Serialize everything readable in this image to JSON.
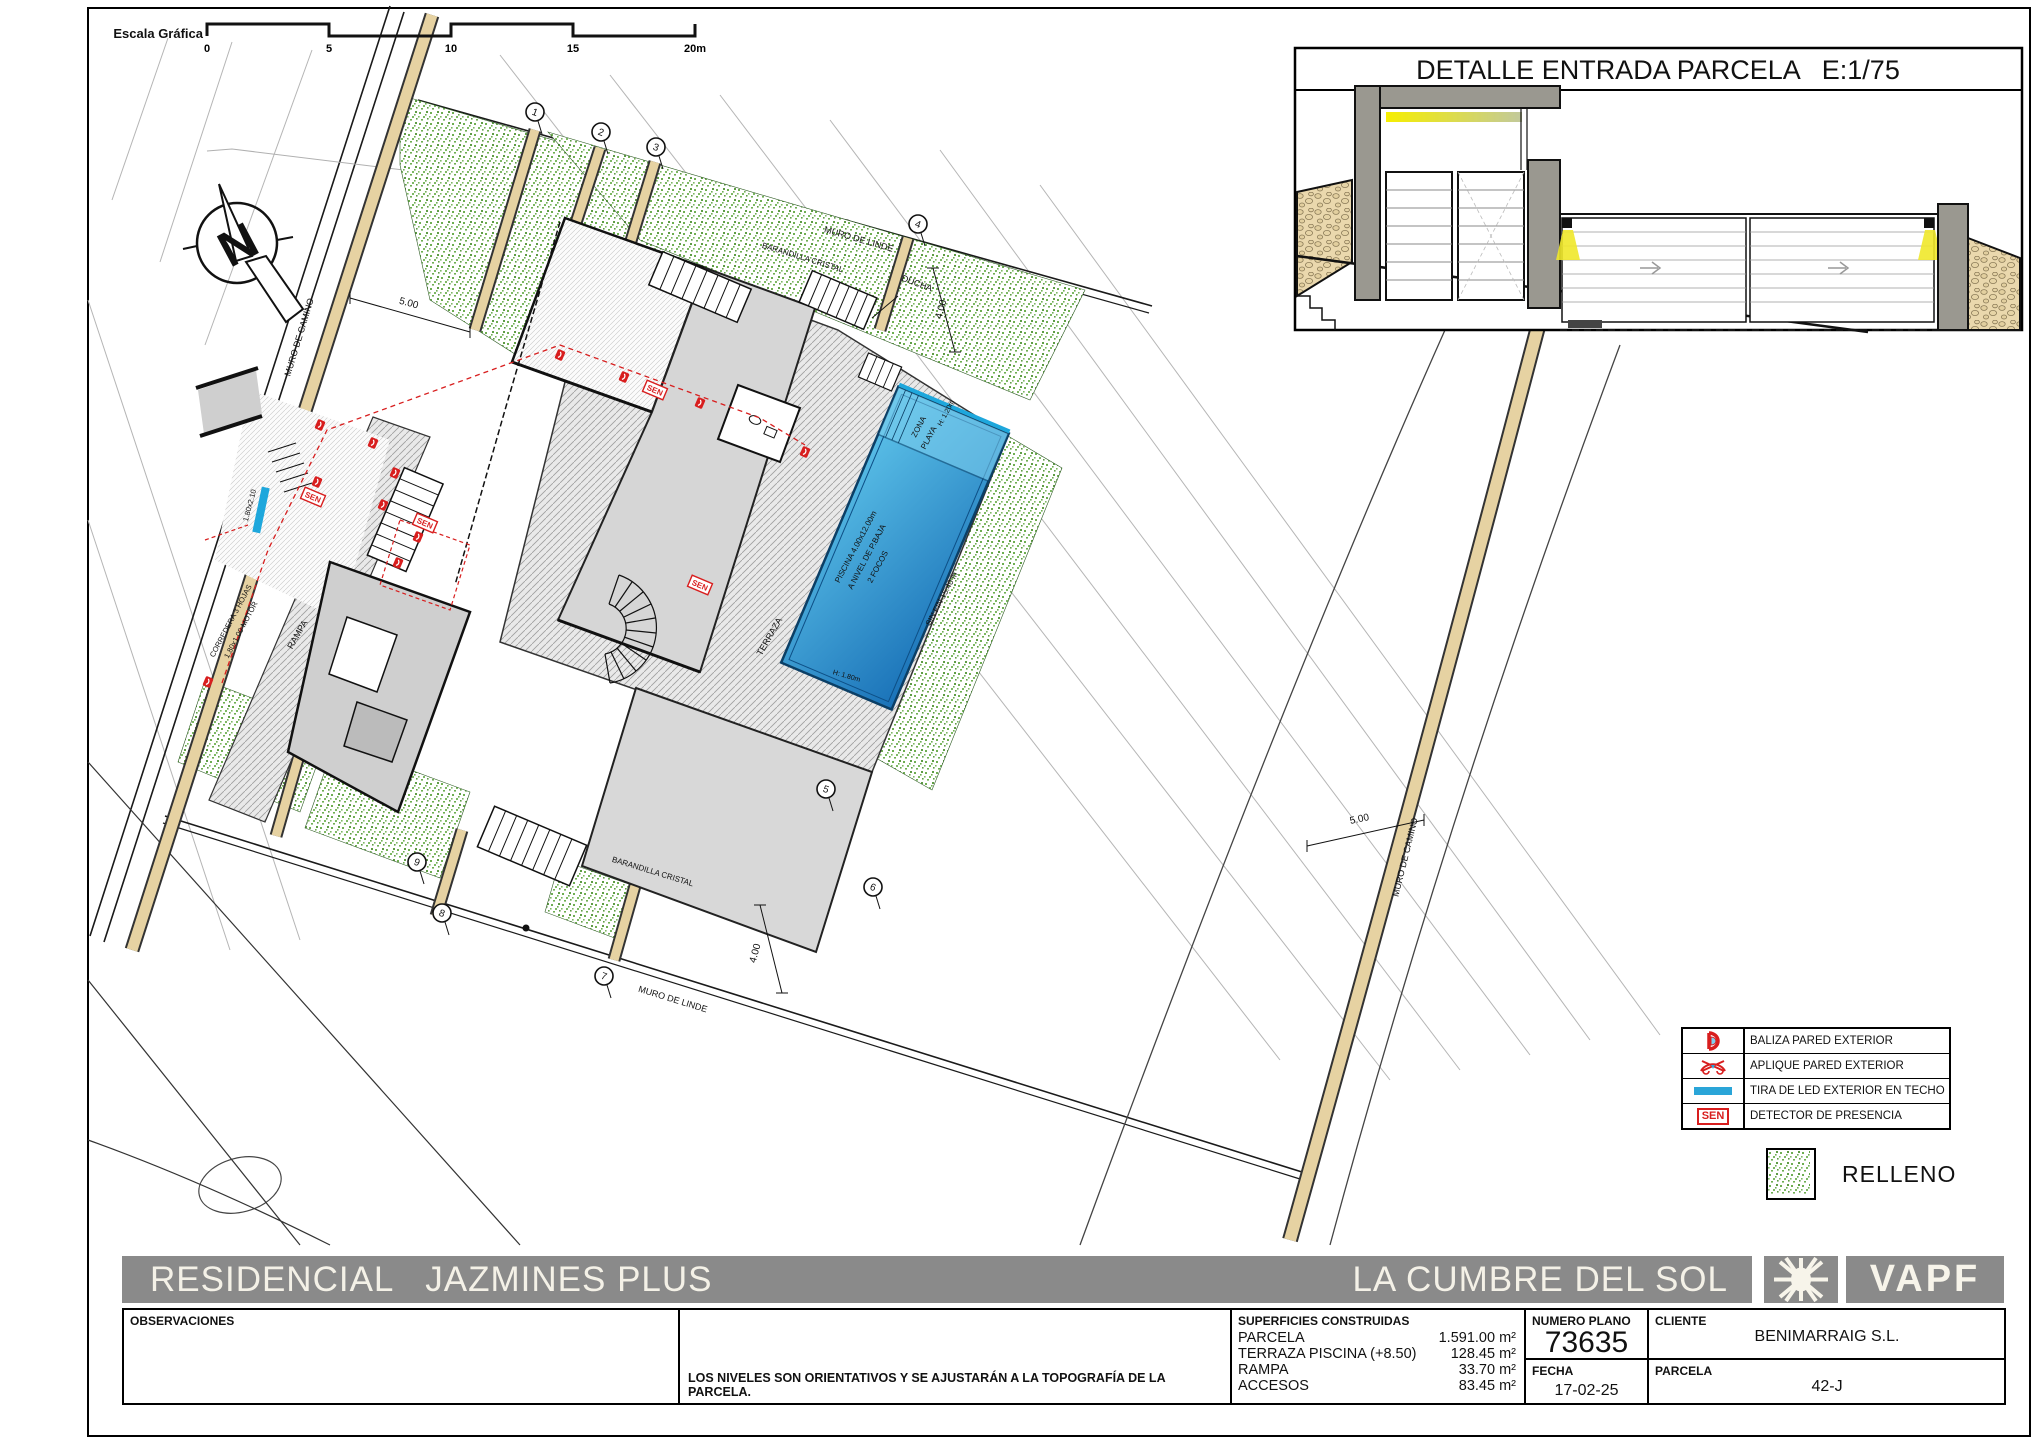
{
  "scale_bar": {
    "label": "Escala Gráfica",
    "ticks": [
      "0",
      "5",
      "10",
      "15",
      "20m"
    ]
  },
  "compass": {
    "letter": "N"
  },
  "detail": {
    "title": "DETALLE ENTRADA PARCELA   E:1/75"
  },
  "legend": {
    "rows": [
      {
        "icon": "baliza-icon",
        "label": "BALIZA PARED EXTERIOR"
      },
      {
        "icon": "aplique-icon",
        "label": "APLIQUE PARED EXTERIOR"
      },
      {
        "icon": "led-strip-icon",
        "label": "TIRA DE LED EXTERIOR EN TECHO"
      },
      {
        "icon": "sen-icon",
        "label": "DETECTOR DE PRESENCIA"
      }
    ],
    "sen_badge": "SEN",
    "relleno": "RELLENO"
  },
  "titlebar": {
    "project": "RESIDENCIAL   JAZMINES PLUS",
    "location": "LA CUMBRE DEL SOL",
    "brand": "VAPF"
  },
  "footer": {
    "observaciones_label": "OBSERVACIONES",
    "note": "LOS NIVELES SON ORIENTATIVOS Y SE AJUSTARÁN A LA TOPOGRAFÍA DE LA PARCELA.",
    "superficies": {
      "header": "SUPERFICIES CONSTRUIDAS",
      "rows": [
        {
          "label": "PARCELA",
          "value": "1.591.00 m²"
        },
        {
          "label": "TERRAZA PISCINA (+8.50)",
          "value": "128.45 m²"
        },
        {
          "label": "RAMPA",
          "value": "33.70 m²"
        },
        {
          "label": "ACCESOS",
          "value": "83.45 m²"
        }
      ]
    },
    "numero_plano": {
      "label": "NUMERO PLANO",
      "value": "73635"
    },
    "fecha": {
      "label": "FECHA",
      "value": "17-02-25"
    },
    "cliente": {
      "label": "CLIENTE",
      "value": "BENIMARRAIG S.L."
    },
    "parcela": {
      "label": "PARCELA",
      "value": "42-J"
    }
  },
  "colors": {
    "bar_gray": "#8a8a8a",
    "green": "#6fae52",
    "tan": "#e6d2a2",
    "pool_light": "#5ec4ea",
    "pool_dark": "#1a72b8",
    "red": "#d81e1e",
    "cyan": "#1ea7dc",
    "yellow": "#f2e71c"
  },
  "plan": {
    "sen_text": "SEN",
    "labels": [
      {
        "text": "MURO DE CAMINO",
        "x": 302,
        "y": 338,
        "rot": -73,
        "size": 9
      },
      {
        "text": "MURO DE CAMINO",
        "x": 1408,
        "y": 858,
        "rot": -76,
        "size": 9
      },
      {
        "text": "MURO DE LINDE",
        "x": 858,
        "y": 242,
        "rot": 16,
        "size": 9
      },
      {
        "text": "MURO DE LINDE",
        "x": 672,
        "y": 1002,
        "rot": 17,
        "size": 9
      },
      {
        "text": "5.00",
        "x": 408,
        "y": 306,
        "rot": 15,
        "size": 10
      },
      {
        "text": "5.00",
        "x": 1360,
        "y": 822,
        "rot": -12,
        "size": 10
      },
      {
        "text": "4.00",
        "x": 758,
        "y": 954,
        "rot": -75,
        "size": 10
      },
      {
        "text": "4.00",
        "x": 944,
        "y": 310,
        "rot": -75,
        "size": 10
      },
      {
        "text": "DUCHA",
        "x": 916,
        "y": 286,
        "rot": 20,
        "size": 9
      },
      {
        "text": "BARANDILLA CRISTAL",
        "x": 802,
        "y": 260,
        "rot": 17,
        "size": 8
      },
      {
        "text": "BARANDILLA CRISTAL",
        "x": 652,
        "y": 874,
        "rot": 17,
        "size": 8
      },
      {
        "text": "TERRAZA",
        "x": 772,
        "y": 638,
        "rot": -60,
        "size": 9
      },
      {
        "text": "RAMPA",
        "x": 300,
        "y": 636,
        "rot": -60,
        "size": 9
      },
      {
        "text": "ZONA",
        "x": 921,
        "y": 428,
        "rot": -62,
        "size": 8
      },
      {
        "text": "PLAYA",
        "x": 931,
        "y": 439,
        "rot": -62,
        "size": 8
      },
      {
        "text": "PISCINA 4.00x12.00m",
        "x": 858,
        "y": 548,
        "rot": -62,
        "size": 8
      },
      {
        "text": "A NIVEL DE P.BAJA",
        "x": 869,
        "y": 558,
        "rot": -62,
        "size": 8
      },
      {
        "text": "2 FOCOS",
        "x": 880,
        "y": 568,
        "rot": -62,
        "size": 8
      },
      {
        "text": "SIN FIN 15.40 m",
        "x": 944,
        "y": 600,
        "rot": -62,
        "size": 8
      },
      {
        "text": "H: 1.20m",
        "x": 948,
        "y": 414,
        "rot": -62,
        "size": 7
      },
      {
        "text": "H: 1.80m",
        "x": 846,
        "y": 678,
        "rot": 16,
        "size": 7
      },
      {
        "text": "CORREDERA 3 HOJAS",
        "x": 233,
        "y": 622,
        "rot": -62,
        "size": 7.5
      },
      {
        "text": "1.80x1.00 MOTOR",
        "x": 243,
        "y": 631,
        "rot": -62,
        "size": 7.5
      },
      {
        "text": "1.80x2.10",
        "x": 252,
        "y": 506,
        "rot": -75,
        "size": 7.5
      }
    ],
    "markers": [
      {
        "n": "1",
        "x": 535,
        "y": 112
      },
      {
        "n": "2",
        "x": 601,
        "y": 132
      },
      {
        "n": "3",
        "x": 656,
        "y": 147
      },
      {
        "n": "4",
        "x": 918,
        "y": 224
      },
      {
        "n": "5",
        "x": 826,
        "y": 789
      },
      {
        "n": "6",
        "x": 873,
        "y": 887
      },
      {
        "n": "7",
        "x": 604,
        "y": 976
      },
      {
        "n": "8",
        "x": 442,
        "y": 913
      },
      {
        "n": "9",
        "x": 417,
        "y": 862
      }
    ],
    "balizas": [
      [
        320,
        425
      ],
      [
        373,
        443
      ],
      [
        317,
        482
      ],
      [
        395,
        473
      ],
      [
        383,
        505
      ],
      [
        418,
        537
      ],
      [
        398,
        563
      ],
      [
        208,
        682
      ],
      [
        560,
        355
      ],
      [
        624,
        377
      ],
      [
        700,
        403
      ],
      [
        805,
        452
      ]
    ],
    "sen_positions": [
      [
        313,
        497
      ],
      [
        425,
        523
      ],
      [
        655,
        390
      ],
      [
        700,
        585
      ]
    ],
    "contours": [
      [
        500,
        55,
        1280,
        1060
      ],
      [
        610,
        75,
        1390,
        1080
      ],
      [
        720,
        95,
        1460,
        1070
      ],
      [
        830,
        120,
        1530,
        1055
      ],
      [
        940,
        150,
        1590,
        1040
      ],
      [
        1040,
        185,
        1660,
        1035
      ],
      [
        88,
        300,
        300,
        940
      ],
      [
        88,
        520,
        230,
        950
      ],
      [
        168,
        38,
        112,
        200
      ],
      [
        232,
        42,
        160,
        262
      ],
      [
        312,
        50,
        205,
        345
      ]
    ]
  }
}
